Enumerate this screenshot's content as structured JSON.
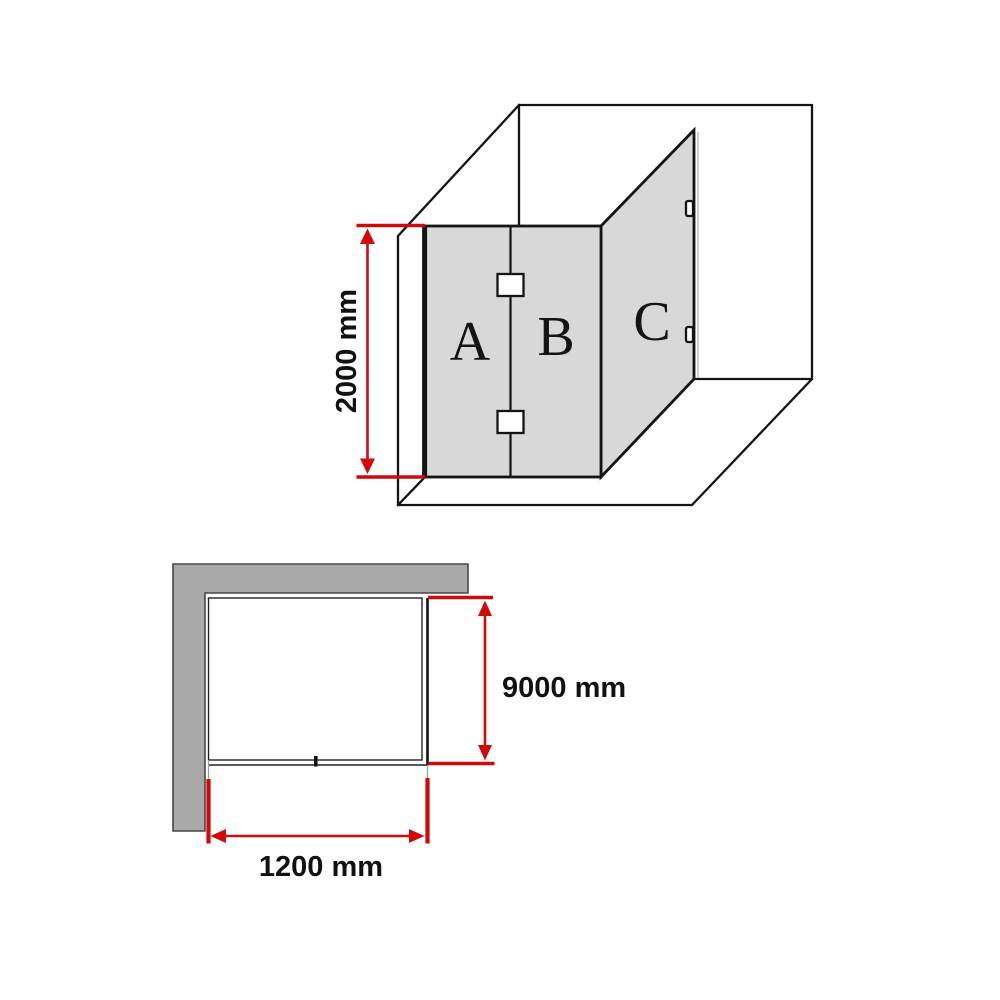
{
  "colors": {
    "dimension_red": "#cf0a0a",
    "glass_fill": "#d8d8d8",
    "wall_fill": "#a9a9a9",
    "line_black": "#141414"
  },
  "elevation": {
    "panel_a_label": "A",
    "panel_b_label": "B",
    "panel_c_label": "C",
    "height_dimension": "2000 mm"
  },
  "plan": {
    "depth_dimension": "9000 mm",
    "width_dimension": "1200 mm"
  }
}
